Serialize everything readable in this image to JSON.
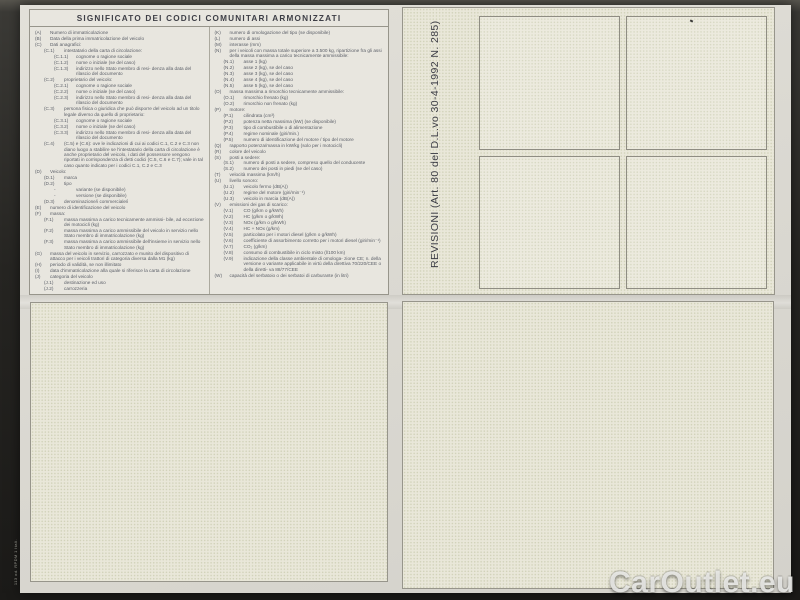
{
  "document": {
    "title": "SIGNIFICATO DEI CODICI COMUNITARI ARMONIZZATI",
    "revisioni_label": "REVISIONI (Art. 80 del D.L.vo 30-4-1992 N. 285)",
    "form_code": "113 od. RPDM 1 Itali.",
    "watermark": "CarOutlet.eu",
    "colors": {
      "photo_background": "#22211f",
      "paper": "#dbd9d2",
      "panel_paper": "#e9e7d9",
      "text": "#5a5e67",
      "border": "#97958b",
      "watermark": "#eeeeec"
    },
    "codes_left": [
      {
        "code": "(A)",
        "text": "Numero di immatricolazione",
        "indent": 0
      },
      {
        "code": "(B)",
        "text": "Data della prima immatricolazione del veicolo",
        "indent": 0
      },
      {
        "code": "(C)",
        "text": "Dati anagrafici:",
        "indent": 0
      },
      {
        "code": "(C.1)",
        "text": "intestatario della carta di circolazione:",
        "indent": 1
      },
      {
        "code": "(C.1.1)",
        "text": "cognome o ragione sociale",
        "indent": 2
      },
      {
        "code": "(C.1.2)",
        "text": "nome o iniziale (se del caso)",
        "indent": 2
      },
      {
        "code": "(C.1.3)",
        "text": "indirizzo nello Stato membro di resi- denza alla data del rilascio del documento",
        "indent": 2
      },
      {
        "code": "(C.2)",
        "text": "proprietario del veicolo:",
        "indent": 1
      },
      {
        "code": "(C.2.1)",
        "text": "cognome o ragione sociale",
        "indent": 2
      },
      {
        "code": "(C.2.2)",
        "text": "nome o iniziale (se del caso)",
        "indent": 2
      },
      {
        "code": "(C.2.3)",
        "text": "indirizzo nello Stato membro di resi- denza alla data del rilascio del documento",
        "indent": 2
      },
      {
        "code": "(C.3)",
        "text": "persona fisica o giuridica che può disporre del veicolo ad un titolo legale diverso da quello di proprietario:",
        "indent": 1
      },
      {
        "code": "(C.3.1)",
        "text": "cognome o ragione sociale",
        "indent": 2
      },
      {
        "code": "(C.3.2)",
        "text": "nome o iniziale (se del caso)",
        "indent": 2
      },
      {
        "code": "(C.3.3)",
        "text": "indirizzo nello Stato membro di resi- denza alla data del rilascio del documento",
        "indent": 2
      },
      {
        "code": "(C.4)",
        "text": "(C.5) e (C.6): ove le indicazioni di cui ai codici C.1, C.2 e C.3 non diano luogo a stabilire se l'intestatario della carta di circolazione è anche proprietario del veicolo, i dati del possessore vengono riportati in corrispondenza di detti codici (C.5, C.6 e C.7); vale in tal caso quanto indicato per i codici C.1, C.2 e C.3",
        "indent": 1
      },
      {
        "code": "(D)",
        "text": "Veicolo:",
        "indent": 0
      },
      {
        "code": "(D.1)",
        "text": "marca",
        "indent": 1
      },
      {
        "code": "(D.2)",
        "text": "tipo",
        "indent": 1
      },
      {
        "code": "-",
        "text": "variante (se disponibile)",
        "indent": 2
      },
      {
        "code": "-",
        "text": "versione (se disponibile)",
        "indent": 2
      },
      {
        "code": "(D.3)",
        "text": "denominazione/i commerciale/i",
        "indent": 1
      },
      {
        "code": "(E)",
        "text": "numero di identificazione del veicolo",
        "indent": 0
      },
      {
        "code": "(F)",
        "text": "massa:",
        "indent": 0
      },
      {
        "code": "(F.1)",
        "text": "massa massima a carico tecnicamente ammissi- bile, ad eccezione dei motocicli (kg)",
        "indent": 1
      },
      {
        "code": "(F.2)",
        "text": "massa massima a carico ammissibile del veicolo in servizio nello Stato membro di immatricolazione (kg)",
        "indent": 1
      },
      {
        "code": "(F.3)",
        "text": "massa massima a carico ammissibile dell'insieme in servizio nello Stato membro di immatricolazione (kg)",
        "indent": 1
      },
      {
        "code": "(G)",
        "text": "massa del veicolo in servizio, carrozzato e munito del dispositivo di attacco per i veicoli trattori di categoria diversa dalla M1 (kg)",
        "indent": 0
      },
      {
        "code": "(H)",
        "text": "periodo di validità, se non illimitato",
        "indent": 0
      },
      {
        "code": "(I)",
        "text": "data d'immatricolazione alla quale si riferisce la carta di circolazione",
        "indent": 0
      },
      {
        "code": "(J)",
        "text": "categoria del veicolo",
        "indent": 0
      },
      {
        "code": "(J.1)",
        "text": "destinazione ed uso",
        "indent": 1
      },
      {
        "code": "(J.2)",
        "text": "carrozzeria",
        "indent": 1
      }
    ],
    "codes_right": [
      {
        "code": "(K)",
        "text": "numero di omologazione del tipo (se disponibile)",
        "indent": 0
      },
      {
        "code": "(L)",
        "text": "numero di assi",
        "indent": 0
      },
      {
        "code": "(M)",
        "text": "interasse (mm)",
        "indent": 0
      },
      {
        "code": "(N)",
        "text": "per i veicoli con massa totale superiore a 3.500 kg, ripartizione fra gli assi della massa massima a carico tecnicamente ammissibile:",
        "indent": 0
      },
      {
        "code": "(N.1)",
        "text": "asse 1 (kg)",
        "indent": 1
      },
      {
        "code": "(N.2)",
        "text": "asse 2 (kg), se del caso",
        "indent": 1
      },
      {
        "code": "(N.3)",
        "text": "asse 3 (kg), se del caso",
        "indent": 1
      },
      {
        "code": "(N.4)",
        "text": "asse 4 (kg), se del caso",
        "indent": 1
      },
      {
        "code": "(N.5)",
        "text": "asse 5 (kg), se del caso",
        "indent": 1
      },
      {
        "code": "(O)",
        "text": "massa massima a rimorchio tecnicamente ammissibile:",
        "indent": 0
      },
      {
        "code": "(O.1)",
        "text": "rimorchio frenato (kg)",
        "indent": 1
      },
      {
        "code": "(O.2)",
        "text": "rimorchio non frenato (kg)",
        "indent": 1
      },
      {
        "code": "(P)",
        "text": "motore:",
        "indent": 0
      },
      {
        "code": "(P.1)",
        "text": "cilindrata (cm³)",
        "indent": 1
      },
      {
        "code": "(P.2)",
        "text": "potenza netta massima (kW) (se disponibile)",
        "indent": 1
      },
      {
        "code": "(P.3)",
        "text": "tipo di combustibile o di alimentazione",
        "indent": 1
      },
      {
        "code": "(P.4)",
        "text": "regime nominale (giri/min.)",
        "indent": 1
      },
      {
        "code": "(P.5)",
        "text": "numero di identificazione del motore / tipo del motore",
        "indent": 1
      },
      {
        "code": "(Q)",
        "text": "rapporto potenza/massa in kW/kg (solo per i motocicli)",
        "indent": 0
      },
      {
        "code": "(R)",
        "text": "colore del veicolo",
        "indent": 0
      },
      {
        "code": "(S)",
        "text": "posti a sedere:",
        "indent": 0
      },
      {
        "code": "(S.1)",
        "text": "numero di posti a sedere, compreso quello del conducente",
        "indent": 1
      },
      {
        "code": "(S.2)",
        "text": "numero dei posti in piedi (se del caso)",
        "indent": 1
      },
      {
        "code": "(T)",
        "text": "velocità massima (km/h)",
        "indent": 0
      },
      {
        "code": "(U)",
        "text": "livello sonoro:",
        "indent": 0
      },
      {
        "code": "(U.1)",
        "text": "veicolo fermo (dB(A))",
        "indent": 1
      },
      {
        "code": "(U.2)",
        "text": "regime del motore (giri/min⁻¹)",
        "indent": 1
      },
      {
        "code": "(U.3)",
        "text": "veicolo in marcia (dB(A))",
        "indent": 1
      },
      {
        "code": "(V)",
        "text": "emissioni dei gas di scarico:",
        "indent": 0
      },
      {
        "code": "(V.1)",
        "text": "CO (g/km o g/kWh)",
        "indent": 1
      },
      {
        "code": "(V.2)",
        "text": "HC (g/km o g/kWh)",
        "indent": 1
      },
      {
        "code": "(V.3)",
        "text": "NOx (g/km o g/kWh)",
        "indent": 1
      },
      {
        "code": "(V.4)",
        "text": "HC + NOx (g/km)",
        "indent": 1
      },
      {
        "code": "(V.5)",
        "text": "particolato per i motori diesel (g/km o g/kWh)",
        "indent": 1
      },
      {
        "code": "(V.6)",
        "text": "coefficiente di assorbimento corretto per i motori diesel (giri/min⁻¹)",
        "indent": 1
      },
      {
        "code": "(V.7)",
        "text": "CO₂ (g/km)",
        "indent": 1
      },
      {
        "code": "(V.8)",
        "text": "consumo di combustibile in ciclo misto (l/100 km)",
        "indent": 1
      },
      {
        "code": "(V.9)",
        "text": "indicazione della classe ambientale di omologa- zione CE; n. della versione o variante applicabile in virtù della direttiva 70/220/CEE o della diretti- va 88/77/CEE",
        "indent": 1
      },
      {
        "code": "(W)",
        "text": "capacità del serbatoio o dei serbatoi di carburante (in litri)",
        "indent": 0
      }
    ]
  }
}
